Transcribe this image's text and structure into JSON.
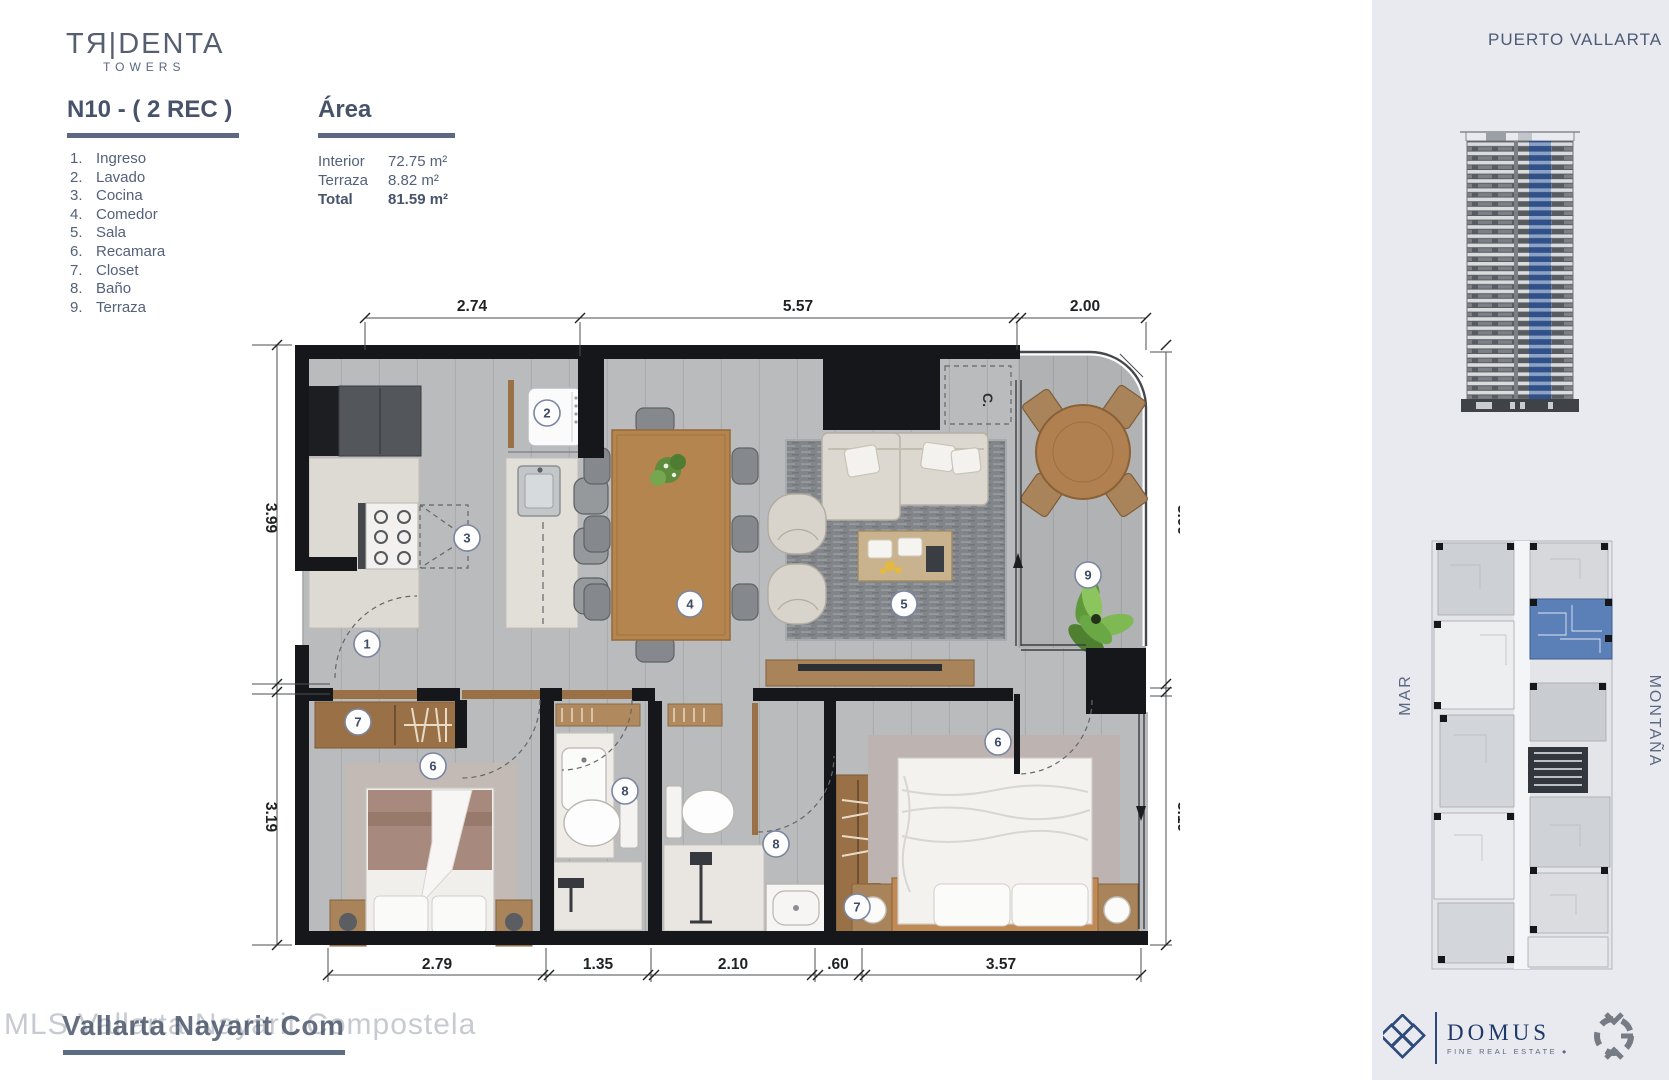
{
  "brand": {
    "logo_main": "TЯ|DENTA",
    "logo_sub": "TOWERS"
  },
  "header": {
    "unit_title": "N10 - ( 2 REC )",
    "area_title": "Área"
  },
  "legend": {
    "items": [
      "Ingreso",
      "Lavado",
      "Cocina",
      "Comedor",
      "Sala",
      "Recamara",
      "Closet",
      "Baño",
      "Terraza"
    ]
  },
  "area_table": {
    "rows": [
      {
        "label": "Interior",
        "value": "72.75 m²",
        "bold": false
      },
      {
        "label": "Terraza",
        "value": "8.82 m²",
        "bold": false
      },
      {
        "label": "Total",
        "value": "81.59 m²",
        "bold": true
      }
    ]
  },
  "plan": {
    "closet_label": "C.",
    "dimensions": {
      "top": [
        {
          "text": "2.74",
          "x": 472
        },
        {
          "text": "5.57",
          "x": 798
        },
        {
          "text": "2.00",
          "x": 1085
        }
      ],
      "bottom": [
        {
          "text": "2.79",
          "x": 437
        },
        {
          "text": "1.35",
          "x": 598
        },
        {
          "text": "2.10",
          "x": 733
        },
        {
          "text": ".60",
          "x": 838
        },
        {
          "text": "3.57",
          "x": 1001
        }
      ],
      "left": [
        {
          "text": "3.99",
          "y": 518
        },
        {
          "text": "3.19",
          "y": 817
        }
      ],
      "right": [
        {
          "text": "3.99",
          "y": 520
        },
        {
          "text": "3.19",
          "y": 817
        }
      ]
    },
    "room_markers": [
      {
        "n": "1",
        "x": 367,
        "y": 644
      },
      {
        "n": "2",
        "x": 547,
        "y": 413
      },
      {
        "n": "3",
        "x": 467,
        "y": 538
      },
      {
        "n": "4",
        "x": 690,
        "y": 604
      },
      {
        "n": "5",
        "x": 904,
        "y": 604
      },
      {
        "n": "6",
        "x": 433,
        "y": 766
      },
      {
        "n": "7",
        "x": 358,
        "y": 722
      },
      {
        "n": "8",
        "x": 625,
        "y": 791
      },
      {
        "n": "8",
        "x": 776,
        "y": 844
      },
      {
        "n": "7",
        "x": 857,
        "y": 907
      },
      {
        "n": "6",
        "x": 998,
        "y": 742
      },
      {
        "n": "9",
        "x": 1088,
        "y": 575
      }
    ]
  },
  "sidebar": {
    "location": "PUERTO VALLARTA",
    "orientation_left": "MAR",
    "orientation_right": "MONTAÑA",
    "domus": {
      "name": "DOMUS",
      "tagline": "FINE REAL ESTATE  ●"
    }
  },
  "watermark": {
    "light": "MLS Vallarta Nayarit Compostela",
    "dark": "Vallarta Nayarit Com"
  },
  "colors": {
    "accent_blue": "#5b7fb7",
    "slate": "#5b6880",
    "wall": "#15171b"
  }
}
